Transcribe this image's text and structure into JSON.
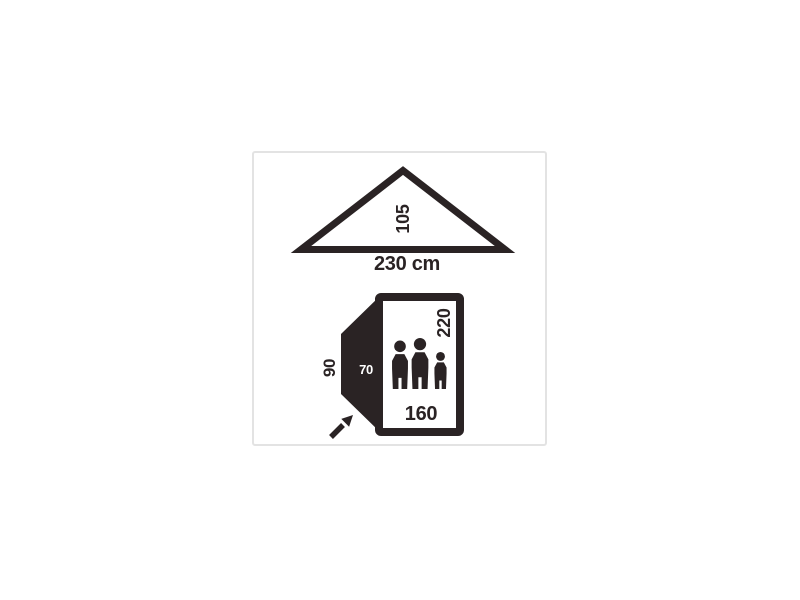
{
  "diagram_title": "tent dimensions diagram",
  "colors": {
    "ink": "#2a2324",
    "card_border": "#e3e3e3",
    "background": "#ffffff",
    "vestibule_label_color": "#ffffff"
  },
  "front_view": {
    "height_label": "105",
    "width_label": "230 cm"
  },
  "floor_plan": {
    "bedroom_length_label": "220",
    "bedroom_width_label": "160",
    "vestibule_depth_label": "70",
    "vestibule_width_label": "90",
    "occupants": {
      "adults": 2,
      "children": 1,
      "total": 3
    }
  },
  "dimensions_cm": {
    "front_width": 230,
    "front_height": 105,
    "bedroom_width": 160,
    "bedroom_length": 220,
    "vestibule_depth": 70,
    "vestibule_width": 90
  }
}
